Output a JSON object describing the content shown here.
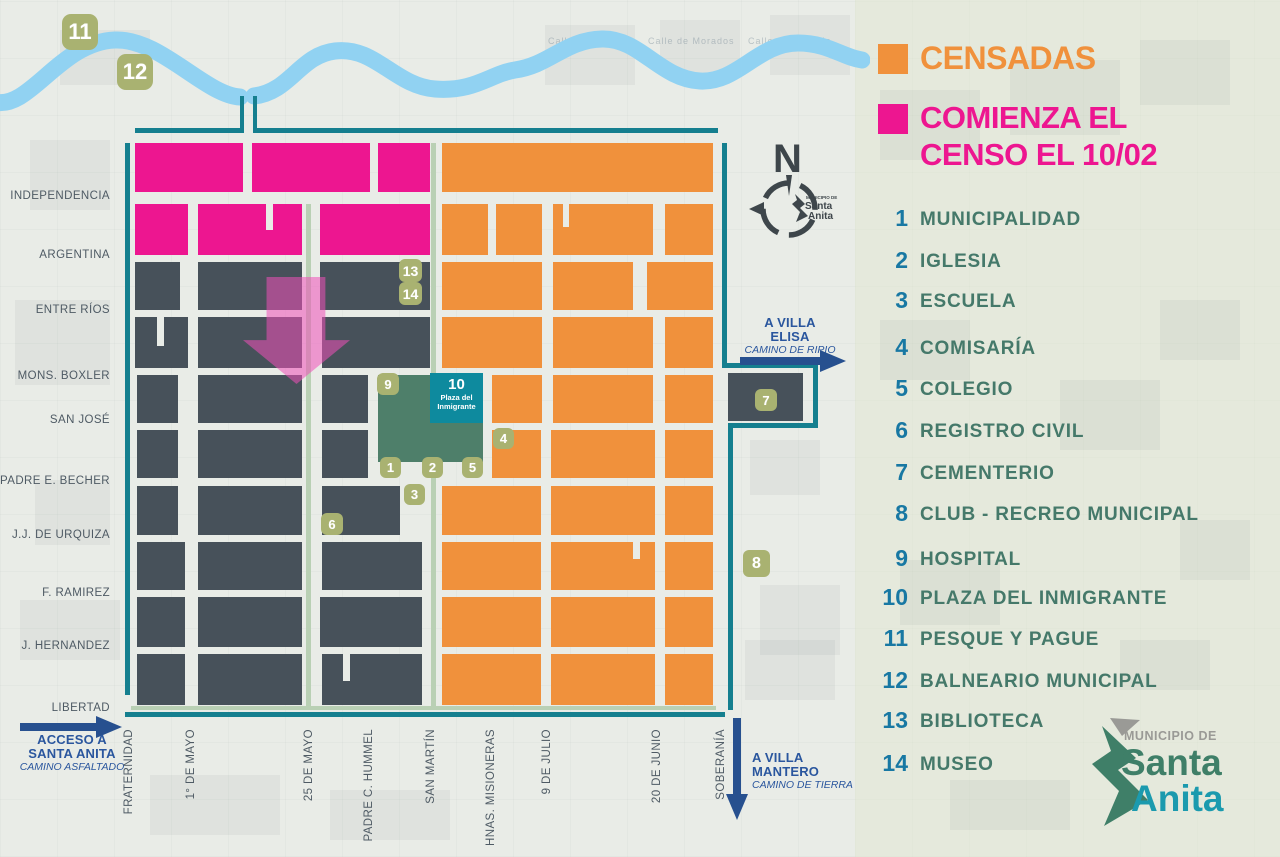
{
  "legend": {
    "censadas": "CENSADAS",
    "comienza_line1": "COMIENZA EL",
    "comienza_line2": "CENSO EL 10/02",
    "items": [
      {
        "n": "1",
        "label": "MUNICIPALIDAD",
        "y": 205
      },
      {
        "n": "2",
        "label": "IGLESIA",
        "y": 247
      },
      {
        "n": "3",
        "label": "ESCUELA",
        "y": 287
      },
      {
        "n": "4",
        "label": "COMISARÍA",
        "y": 334
      },
      {
        "n": "5",
        "label": "COLEGIO",
        "y": 375
      },
      {
        "n": "6",
        "label": "REGISTRO CIVIL",
        "y": 417
      },
      {
        "n": "7",
        "label": "CEMENTERIO",
        "y": 459
      },
      {
        "n": "8",
        "label": "CLUB - RECREO MUNICIPAL",
        "y": 500
      },
      {
        "n": "9",
        "label": "HOSPITAL",
        "y": 545
      },
      {
        "n": "10",
        "label": "PLAZA DEL INMIGRANTE",
        "y": 584
      },
      {
        "n": "11",
        "label": "PESQUE Y PAGUE",
        "y": 625
      },
      {
        "n": "12",
        "label": "BALNEARIO MUNICIPAL",
        "y": 667
      },
      {
        "n": "13",
        "label": "BIBLIOTECA",
        "y": 707
      },
      {
        "n": "14",
        "label": "MUSEO",
        "y": 750
      }
    ]
  },
  "logo": {
    "municipio_de": "MUNICIPIO DE",
    "santa": "Santa",
    "anita": "Anita"
  },
  "compass": {
    "n": "N",
    "logo_line1": "MUNICIPIO DE",
    "logo_line2": "Santa",
    "logo_line3": "Anita"
  },
  "plaza_box": {
    "number": "10",
    "line1": "Plaza del",
    "line2": "Inmigrante"
  },
  "roads": {
    "acceso": {
      "line1": "ACCESO A",
      "line2": "SANTA ANITA",
      "line3": "CAMINO ASFALTADO"
    },
    "villa_elisa": {
      "line1": "A VILLA",
      "line2": "ELISA",
      "line3": "CAMINO DE RIPIO"
    },
    "villa_mantero": {
      "line1": "A VILLA",
      "line2": "MANTERO",
      "line3": "CAMINO DE TIERRA"
    }
  },
  "streets_left": [
    {
      "t": "INDEPENDENCIA",
      "y": 198
    },
    {
      "t": "ARGENTINA",
      "y": 257
    },
    {
      "t": "ENTRE RÍOS",
      "y": 312
    },
    {
      "t": "MONS. BOXLER",
      "y": 378
    },
    {
      "t": "SAN JOSÉ",
      "y": 422
    },
    {
      "t": "PADRE E. BECHER",
      "y": 483
    },
    {
      "t": "J.J. DE URQUIZA",
      "y": 537
    },
    {
      "t": "F. RAMIREZ",
      "y": 595
    },
    {
      "t": "J. HERNANDEZ",
      "y": 648
    },
    {
      "t": "LIBERTAD",
      "y": 710
    }
  ],
  "streets_bottom": [
    {
      "t": "FRATERNIDAD",
      "x": 130
    },
    {
      "t": "1° DE MAYO",
      "x": 192
    },
    {
      "t": "25 DE MAYO",
      "x": 310
    },
    {
      "t": "PADRE C. HUMMEL",
      "x": 370
    },
    {
      "t": "SAN MARTÍN",
      "x": 432
    },
    {
      "t": "HNAS. MISIONERAS",
      "x": 492
    },
    {
      "t": "9 DE JULIO",
      "x": 548
    },
    {
      "t": "20 DE JUNIO",
      "x": 658
    },
    {
      "t": "SOBERANÍA",
      "x": 722
    }
  ],
  "badges": [
    {
      "n": "11",
      "x": 62,
      "y": 14,
      "s": 36
    },
    {
      "n": "12",
      "x": 117,
      "y": 54,
      "s": 36
    },
    {
      "n": "13",
      "x": 399,
      "y": 259,
      "s": 23
    },
    {
      "n": "14",
      "x": 399,
      "y": 282,
      "s": 23
    },
    {
      "n": "9",
      "x": 377,
      "y": 373,
      "s": 22
    },
    {
      "n": "4",
      "x": 493,
      "y": 428,
      "s": 21
    },
    {
      "n": "1",
      "x": 380,
      "y": 457,
      "s": 21
    },
    {
      "n": "2",
      "x": 422,
      "y": 457,
      "s": 21
    },
    {
      "n": "5",
      "x": 462,
      "y": 457,
      "s": 21
    },
    {
      "n": "3",
      "x": 404,
      "y": 484,
      "s": 21
    },
    {
      "n": "6",
      "x": 321,
      "y": 513,
      "s": 22
    },
    {
      "n": "7",
      "x": 755,
      "y": 389,
      "s": 22
    },
    {
      "n": "8",
      "x": 743,
      "y": 550,
      "s": 27
    }
  ],
  "blocks": [
    [
      135,
      143,
      108,
      49,
      "p"
    ],
    [
      252,
      143,
      118,
      49,
      "p"
    ],
    [
      378,
      143,
      52,
      49,
      "p"
    ],
    [
      442,
      143,
      271,
      49,
      "o"
    ],
    [
      135,
      204,
      53,
      51,
      "p"
    ],
    [
      198,
      204,
      104,
      51,
      "p"
    ],
    [
      320,
      204,
      110,
      51,
      "p"
    ],
    [
      442,
      204,
      46,
      51,
      "o"
    ],
    [
      496,
      204,
      46,
      51,
      "o"
    ],
    [
      553,
      204,
      100,
      51,
      "o"
    ],
    [
      665,
      204,
      48,
      51,
      "o"
    ],
    [
      266,
      204,
      7,
      26,
      "n"
    ],
    [
      563,
      204,
      6,
      23,
      "n"
    ],
    [
      135,
      262,
      45,
      48,
      "d"
    ],
    [
      198,
      262,
      104,
      48,
      "d"
    ],
    [
      320,
      262,
      110,
      48,
      "d"
    ],
    [
      442,
      262,
      100,
      48,
      "o"
    ],
    [
      553,
      262,
      80,
      48,
      "o"
    ],
    [
      647,
      262,
      66,
      48,
      "o"
    ],
    [
      135,
      317,
      53,
      51,
      "d"
    ],
    [
      198,
      317,
      104,
      51,
      "d"
    ],
    [
      322,
      317,
      108,
      51,
      "d"
    ],
    [
      442,
      317,
      100,
      51,
      "o"
    ],
    [
      553,
      317,
      100,
      51,
      "o"
    ],
    [
      665,
      317,
      48,
      51,
      "o"
    ],
    [
      157,
      317,
      7,
      29,
      "n"
    ],
    [
      137,
      375,
      41,
      48,
      "d"
    ],
    [
      198,
      375,
      104,
      48,
      "d"
    ],
    [
      322,
      375,
      46,
      48,
      "d"
    ],
    [
      378,
      375,
      105,
      87,
      "g"
    ],
    [
      492,
      375,
      50,
      48,
      "o"
    ],
    [
      553,
      375,
      100,
      48,
      "o"
    ],
    [
      665,
      375,
      48,
      48,
      "o"
    ],
    [
      137,
      430,
      41,
      48,
      "d"
    ],
    [
      198,
      430,
      104,
      48,
      "d"
    ],
    [
      322,
      430,
      46,
      48,
      "d"
    ],
    [
      492,
      430,
      49,
      48,
      "o"
    ],
    [
      551,
      430,
      104,
      48,
      "o"
    ],
    [
      665,
      430,
      48,
      48,
      "o"
    ],
    [
      137,
      486,
      41,
      49,
      "d"
    ],
    [
      198,
      486,
      104,
      49,
      "d"
    ],
    [
      322,
      486,
      78,
      49,
      "d"
    ],
    [
      442,
      486,
      99,
      49,
      "o"
    ],
    [
      551,
      486,
      104,
      49,
      "o"
    ],
    [
      665,
      486,
      48,
      49,
      "o"
    ],
    [
      137,
      542,
      48,
      48,
      "d"
    ],
    [
      198,
      542,
      104,
      48,
      "d"
    ],
    [
      322,
      542,
      100,
      48,
      "d"
    ],
    [
      442,
      542,
      99,
      48,
      "o"
    ],
    [
      551,
      542,
      104,
      48,
      "o"
    ],
    [
      665,
      542,
      48,
      48,
      "o"
    ],
    [
      633,
      542,
      7,
      17,
      "n"
    ],
    [
      137,
      597,
      48,
      50,
      "d"
    ],
    [
      198,
      597,
      104,
      50,
      "d"
    ],
    [
      320,
      597,
      102,
      50,
      "d"
    ],
    [
      442,
      597,
      99,
      50,
      "o"
    ],
    [
      551,
      597,
      104,
      50,
      "o"
    ],
    [
      665,
      597,
      48,
      50,
      "o"
    ],
    [
      137,
      654,
      48,
      51,
      "d"
    ],
    [
      198,
      654,
      104,
      51,
      "d"
    ],
    [
      322,
      654,
      100,
      51,
      "d"
    ],
    [
      442,
      654,
      99,
      51,
      "o"
    ],
    [
      551,
      654,
      104,
      51,
      "o"
    ],
    [
      665,
      654,
      48,
      51,
      "o"
    ],
    [
      343,
      654,
      7,
      27,
      "n"
    ],
    [
      728,
      373,
      75,
      48,
      "d"
    ]
  ],
  "lines": [
    [
      135,
      128,
      108,
      5,
      "teal"
    ],
    [
      253,
      128,
      465,
      5,
      "teal"
    ],
    [
      240,
      96,
      4,
      37,
      "teal"
    ],
    [
      253,
      96,
      4,
      37,
      "teal"
    ],
    [
      125,
      143,
      5,
      552,
      "teal"
    ],
    [
      722,
      143,
      5,
      222,
      "teal"
    ],
    [
      722,
      363,
      95,
      5,
      "teal"
    ],
    [
      813,
      363,
      5,
      65,
      "teal"
    ],
    [
      728,
      423,
      90,
      5,
      "teal"
    ],
    [
      728,
      423,
      5,
      287,
      "teal"
    ],
    [
      125,
      712,
      600,
      5,
      "teal"
    ],
    [
      131,
      706,
      585,
      4,
      "sage"
    ],
    [
      306,
      204,
      5,
      502,
      "sage"
    ],
    [
      431,
      143,
      5,
      232,
      "sage"
    ],
    [
      431,
      462,
      5,
      244,
      "sage"
    ]
  ],
  "bg_texture": {
    "rects": [
      [
        60,
        30,
        90,
        55
      ],
      [
        30,
        140,
        80,
        70
      ],
      [
        15,
        300,
        95,
        85
      ],
      [
        35,
        480,
        75,
        65
      ],
      [
        20,
        600,
        100,
        60
      ],
      [
        150,
        775,
        130,
        60
      ],
      [
        330,
        790,
        120,
        50
      ],
      [
        545,
        25,
        90,
        60
      ],
      [
        660,
        20,
        80,
        55
      ],
      [
        770,
        15,
        80,
        60
      ],
      [
        750,
        440,
        70,
        55
      ],
      [
        760,
        585,
        80,
        70
      ],
      [
        745,
        640,
        90,
        60
      ],
      [
        880,
        90,
        100,
        70
      ],
      [
        1010,
        60,
        110,
        75
      ],
      [
        1140,
        40,
        90,
        65
      ],
      [
        880,
        320,
        90,
        60
      ],
      [
        1060,
        380,
        100,
        70
      ],
      [
        1160,
        300,
        80,
        60
      ],
      [
        900,
        560,
        100,
        65
      ],
      [
        1180,
        520,
        70,
        60
      ],
      [
        950,
        780,
        120,
        50
      ],
      [
        1120,
        640,
        90,
        50
      ]
    ],
    "labels": [
      {
        "t": "Calle de Hidalgo",
        "x": 548,
        "y": 36
      },
      {
        "t": "Calle de Morados",
        "x": 648,
        "y": 36
      },
      {
        "t": "Calle de Hurtado",
        "x": 748,
        "y": 36
      }
    ]
  },
  "colors": {
    "censadas_orange": "#F0913C",
    "comienza_pink": "#ED1690",
    "block_dark": "#47515A",
    "plaza_green": "#4E7F6A",
    "plaza_box_teal": "#0E8A9E",
    "badge_olive": "#A9B271",
    "border_teal": "#157F8F",
    "street_sage": "#B9D0B4",
    "river_blue": "#91D2F2",
    "road_navy": "#2A569E",
    "legend_number_blue": "#1878A3",
    "legend_label_green": "#45796A",
    "logo_gray": "#9A9A96",
    "logo_green": "#3F7F68",
    "logo_teal": "#1B9AAE"
  }
}
